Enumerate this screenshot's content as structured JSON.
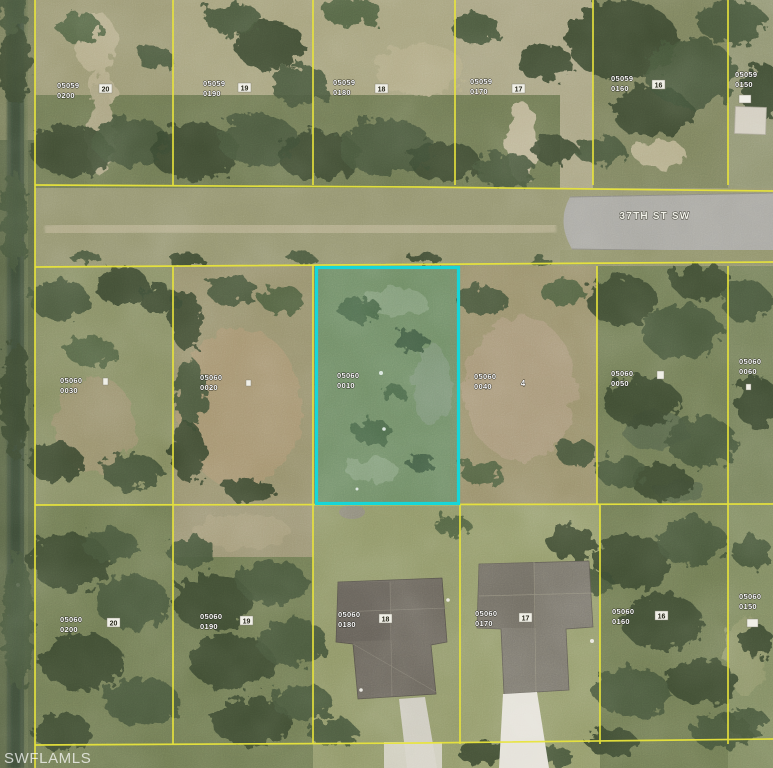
{
  "map": {
    "type": "aerial-parcel-map",
    "street": {
      "name": "37TH ST SW"
    },
    "watermark": "SWFLAMLS",
    "line_color": "#e8e43c",
    "highlight": {
      "parcel_block": "05060",
      "parcel_code": "0010",
      "color": "#17d6d8"
    },
    "parcels": {
      "north_row": [
        {
          "block": "05059",
          "code": "0200",
          "lot": "20"
        },
        {
          "block": "05059",
          "code": "0190",
          "lot": "19"
        },
        {
          "block": "05059",
          "code": "0180",
          "lot": "18"
        },
        {
          "block": "05059",
          "code": "0170",
          "lot": "17"
        },
        {
          "block": "05059",
          "code": "0160",
          "lot": "16"
        },
        {
          "block": "05059",
          "code": "0150",
          "lot": ""
        }
      ],
      "mid_row": [
        {
          "block": "05060",
          "code": "0030",
          "lot": ""
        },
        {
          "block": "05060",
          "code": "0020",
          "lot": ""
        },
        {
          "block": "05060",
          "code": "0010",
          "lot": "",
          "highlighted": true
        },
        {
          "block": "05060",
          "code": "0040",
          "lot": "4"
        },
        {
          "block": "05060",
          "code": "0050",
          "lot": ""
        },
        {
          "block": "05060",
          "code": "0060",
          "lot": ""
        }
      ],
      "south_row": [
        {
          "block": "05060",
          "code": "0200",
          "lot": "20"
        },
        {
          "block": "05060",
          "code": "0190",
          "lot": "19"
        },
        {
          "block": "05060",
          "code": "0180",
          "lot": "18"
        },
        {
          "block": "05060",
          "code": "0170",
          "lot": "17"
        },
        {
          "block": "05060",
          "code": "0160",
          "lot": "16"
        },
        {
          "block": "05060",
          "code": "0150",
          "lot": ""
        }
      ]
    }
  }
}
